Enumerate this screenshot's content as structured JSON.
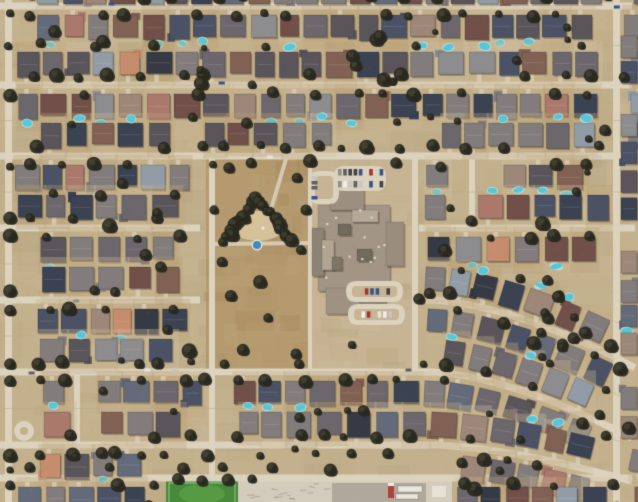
{
  "scene": {
    "type": "satellite-aerial-photo",
    "description": "Overhead satellite view of a dense suburban tract-home neighborhood: rows of gray, slate-blue and brown rooftops with backyard swimming pools and dark street trees, a large brown park with a tree-lined playground and splash pad at center-left, a school campus with parking lots of cars at center, curved streets in the lower right, a green sports field and paved maintenance yard along the bottom edge."
  },
  "seed": 1337,
  "palette": {
    "ground": "#c2b08d",
    "ground_blotches": [
      "#b5a07a",
      "#cdbc9c",
      "#a8936c",
      "#d8c9ab",
      "#9e8a64"
    ],
    "street": "#ddd4c0",
    "alley": "#b7a887",
    "park": "#b3986c",
    "park_blotches": [
      "#a68a5d",
      "#c2a97e",
      "#97794e",
      "#bfa87d"
    ],
    "campus": "#c6b494",
    "campus_blotches": [
      "#b8a480",
      "#d2c2a4",
      "#aa9670"
    ],
    "field_green": "#3f8735",
    "field_green_light": "#5ba448",
    "concrete": "#d3ccbe",
    "concrete_dark": "#a49e92",
    "tree_dark": "#21211a",
    "tree_light": "#454733",
    "pool": "#4fc8dc",
    "pool_rim": "#b8e9ef",
    "sand": "#d9c69e",
    "splash_pad": "#3e84b8",
    "driveway": "#d9cfb8",
    "roof_ridge": "rgba(255,255,255,0.16)",
    "house_shadow": "rgba(45,35,22,0.35)",
    "building_shadow": "rgba(60,50,38,0.35)",
    "roof_unit": "#d8d2c6",
    "truck_red": "#b03a32",
    "trailer_white": "#ece9e2",
    "roof_colors": [
      {
        "c": "#7e7a7b",
        "w": 16
      },
      {
        "c": "#67626a",
        "w": 13
      },
      {
        "c": "#535058",
        "w": 12
      },
      {
        "c": "#444c62",
        "w": 9
      },
      {
        "c": "#333b4f",
        "w": 7
      },
      {
        "c": "#6b4a45",
        "w": 8
      },
      {
        "c": "#7d5c50",
        "w": 6
      },
      {
        "c": "#8f9aa8",
        "w": 4
      },
      {
        "c": "#9a8478",
        "w": 5
      },
      {
        "c": "#a8756a",
        "w": 3
      },
      {
        "c": "#c58b6b",
        "w": 2
      },
      {
        "c": "#2e3340",
        "w": 4
      },
      {
        "c": "#8a8a8e",
        "w": 6
      },
      {
        "c": "#5d6678",
        "w": 5
      }
    ],
    "yard_tints": [
      "#c8b491",
      "#bfa87f",
      "#b59d74",
      "#d2c2a2",
      "#c3ab83",
      "#ba9e6f",
      "#cab58f"
    ],
    "car_colors": [
      "#f2f2f0",
      "#e6e6e3",
      "#c7c7c5",
      "#5a5a5e",
      "#3a3a40",
      "#9e2f2a",
      "#2f4d8a",
      "#8c8c8a"
    ]
  },
  "layout": {
    "width": 638,
    "height": 502,
    "h_streets": [
      {
        "y": 6,
        "segs": [
          [
            0,
            638
          ]
        ]
      },
      {
        "y": 85,
        "segs": [
          [
            0,
            638
          ]
        ]
      },
      {
        "y": 156,
        "segs": [
          [
            0,
            638
          ]
        ]
      },
      {
        "y": 228,
        "segs": [
          [
            0,
            204
          ],
          [
            419,
            638
          ]
        ]
      },
      {
        "y": 300,
        "segs": [
          [
            0,
            204
          ],
          [
            419,
            638
          ]
        ]
      },
      {
        "y": 372,
        "segs": [
          [
            0,
            638
          ]
        ]
      },
      {
        "y": 445,
        "segs": [
          [
            0,
            638
          ]
        ]
      },
      {
        "y": 478,
        "segs": [
          [
            0,
            638
          ]
        ]
      }
    ],
    "v_streets": [
      {
        "x": 5,
        "y": 0,
        "w": 7,
        "h": 502
      },
      {
        "x": 74,
        "y": 370,
        "w": 6,
        "h": 80
      },
      {
        "x": 209,
        "y": 154,
        "w": 6,
        "h": 326
      },
      {
        "x": 308,
        "y": 154,
        "w": 4,
        "h": 220
      },
      {
        "x": 412,
        "y": 154,
        "w": 6,
        "h": 220
      },
      {
        "x": 469,
        "y": 154,
        "w": 6,
        "h": 76
      },
      {
        "x": 613,
        "y": 0,
        "w": 7,
        "h": 502
      }
    ],
    "street_width": 7,
    "curve": {
      "start_x": 430,
      "span": 186,
      "exp": 1.6,
      "max_drop": 58,
      "min_base_y": 300,
      "last_row_y": 445,
      "last_row_factor": 0.55,
      "flat_after_y": 470
    },
    "park": {
      "x": 206,
      "y": 152,
      "w": 105,
      "h": 224
    },
    "campus": {
      "x": 311,
      "y": 152,
      "w": 107,
      "h": 224
    },
    "exclusions": [
      {
        "x": 202,
        "y": 150,
        "w": 220,
        "h": 226
      },
      {
        "x": 163,
        "y": 470,
        "w": 292,
        "h": 32
      }
    ],
    "field": {
      "x": 166,
      "y": 480,
      "w": 72,
      "h": 22
    },
    "concrete": {
      "x": 238,
      "y": 477,
      "w": 214,
      "h": 25
    },
    "concrete_dark_patch": {
      "x": 332,
      "y": 483,
      "w": 94,
      "h": 19
    },
    "cul_de_sac": {
      "x": 24,
      "y": 431,
      "r": 10
    },
    "park_paths": [
      [
        [
          212,
          244
        ],
        [
          310,
          243
        ]
      ],
      [
        [
          286,
          159
        ],
        [
          272,
          206
        ]
      ]
    ],
    "playground": {
      "sand": {
        "cx": 258,
        "cy": 226,
        "rx": 27,
        "ry": 15
      },
      "apex": [
        256,
        199
      ],
      "left": [
        224,
        241
      ],
      "right": [
        291,
        240
      ],
      "splash": {
        "x": 257,
        "y": 245,
        "r": 4
      }
    },
    "school_building": [
      {
        "x": 318,
        "y": 205,
        "w": 72,
        "h": 86,
        "c": "#a09384"
      },
      {
        "x": 330,
        "y": 188,
        "w": 34,
        "h": 22,
        "c": "#998d7e"
      },
      {
        "x": 312,
        "y": 228,
        "w": 12,
        "h": 48,
        "c": "#8a8072"
      },
      {
        "x": 386,
        "y": 222,
        "w": 18,
        "h": 44,
        "c": "#968b7c"
      },
      {
        "x": 326,
        "y": 288,
        "w": 34,
        "h": 26,
        "c": "#9c9082"
      },
      {
        "x": 360,
        "y": 291,
        "w": 26,
        "h": 18,
        "c": "#8a8072"
      },
      {
        "x": 352,
        "y": 210,
        "w": 26,
        "h": 12,
        "c": "#b3a897"
      },
      {
        "x": 322,
        "y": 240,
        "w": 12,
        "h": 30,
        "c": "#b0a492"
      },
      {
        "x": 338,
        "y": 224,
        "w": 13,
        "h": 11,
        "c": "#6d665a"
      },
      {
        "x": 357,
        "y": 249,
        "w": 15,
        "h": 12,
        "c": "#6d665a"
      },
      {
        "x": 332,
        "y": 257,
        "w": 10,
        "h": 13,
        "c": "#7a7265"
      }
    ],
    "building_bbox": {
      "x": 310,
      "y": 186,
      "w": 96,
      "h": 132
    },
    "parking_lots": [
      {
        "x": 309,
        "y": 171,
        "w": 30,
        "h": 33,
        "island": true,
        "vertical": true,
        "cars": 5
      },
      {
        "x": 334,
        "y": 166,
        "w": 52,
        "h": 25,
        "island": false,
        "vertical": false,
        "cars": 13
      },
      {
        "x": 346,
        "y": 281,
        "w": 57,
        "h": 21,
        "island": true,
        "vertical": false,
        "cars": 8
      },
      {
        "x": 348,
        "y": 304,
        "w": 57,
        "h": 21,
        "island": true,
        "vertical": false,
        "cars": 8
      }
    ],
    "right_column": {
      "x": 621,
      "w": 16,
      "h": 22,
      "step": 27
    },
    "extra_top_row": {
      "y": -16,
      "h": 20
    },
    "trailers": {
      "white": [
        [
          398,
          486,
          24,
          6
        ],
        [
          396,
          494,
          22,
          5
        ]
      ],
      "truck": [
        388,
        483,
        6,
        15
      ],
      "shed": [
        432,
        486,
        14,
        11
      ]
    },
    "explicit_trees": [
      [
        178,
        479,
        6
      ],
      [
        202,
        481,
        5
      ],
      [
        228,
        480,
        6
      ],
      [
        252,
        479,
        5
      ],
      [
        310,
        161,
        6
      ],
      [
        297,
        178,
        5
      ],
      [
        231,
        296,
        6
      ],
      [
        268,
        318,
        5
      ],
      [
        243,
        350,
        6
      ],
      [
        296,
        354,
        5
      ],
      [
        222,
        262,
        5
      ],
      [
        301,
        250,
        5
      ],
      [
        396,
        163,
        5
      ],
      [
        419,
        299,
        5
      ],
      [
        229,
        168,
        5
      ],
      [
        251,
        163,
        5
      ],
      [
        214,
        210,
        5
      ],
      [
        306,
        210,
        5
      ],
      [
        260,
        282,
        6
      ],
      [
        352,
        345,
        4
      ]
    ]
  },
  "density": {
    "ground_blotches": 430,
    "park_blotches": 40,
    "campus_blotches": 30,
    "pool_chance": 0.22,
    "driveway_chance": 0.5,
    "l_wing_chance": 0.25,
    "street_tree_chance": 0.62,
    "alley_tree_chance": 0.3,
    "random_trees": 70,
    "street_cars": 11,
    "noise_specks": 1400,
    "rooftop_units": 14,
    "concrete_marks": 16
  }
}
